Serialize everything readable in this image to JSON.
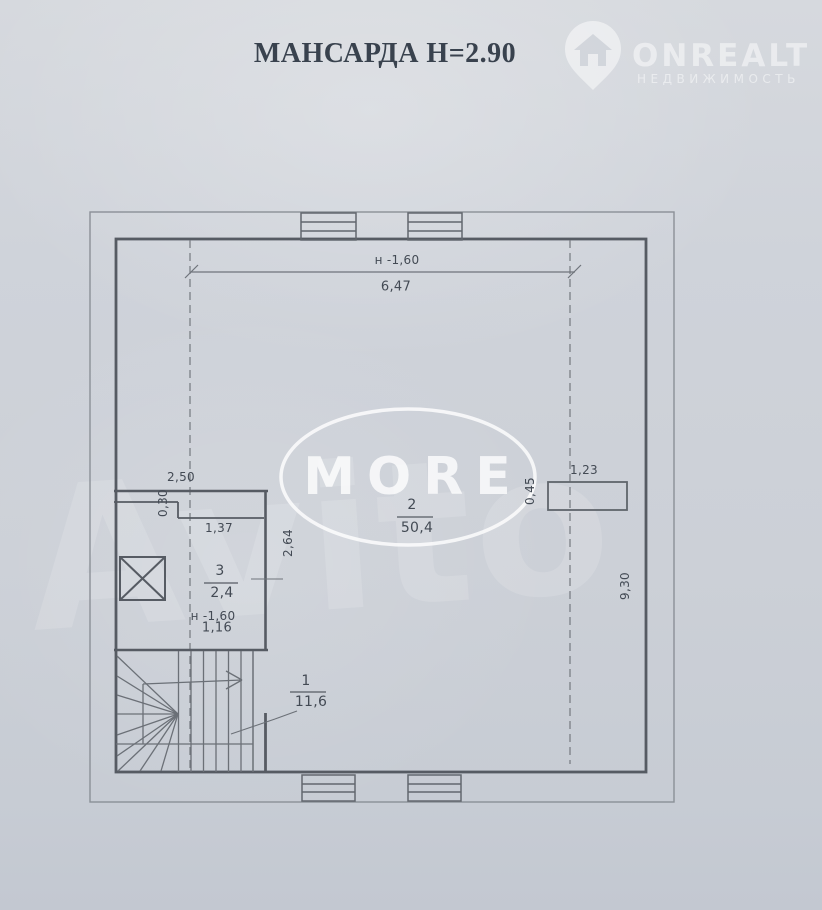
{
  "page": {
    "title": "МАНСАРДА Н=2.90"
  },
  "logo": {
    "name": "ONREALT",
    "subtitle": "НЕДВИЖИМОСТЬ",
    "icon": "map-pin-house-icon"
  },
  "watermarks": {
    "ellipse_text": "MORE",
    "diagonal_text": "Avito"
  },
  "plan": {
    "floor_height": "2.90",
    "rooms": [
      {
        "number": "1",
        "area": "11,6"
      },
      {
        "number": "2",
        "area": "50,4"
      },
      {
        "number": "3",
        "area": "2,4"
      }
    ],
    "dimensions": {
      "top_height_mark": "н -1,60",
      "top_width": "6,47",
      "left_width": "2,50",
      "step_depth": "0,30",
      "niche_width": "1,37",
      "niche_depth": "2,64",
      "room3_height_mark": "н -1,60",
      "room3_width": "1,16",
      "right_offset": "0,45",
      "chimney_width": "1,23",
      "right_depth": "9,30"
    }
  },
  "colors": {
    "paper": "#ced2d9",
    "ink": "#434a54",
    "title_ink": "#39424e",
    "wall": "#565b63",
    "watermark": "#ffffff"
  }
}
